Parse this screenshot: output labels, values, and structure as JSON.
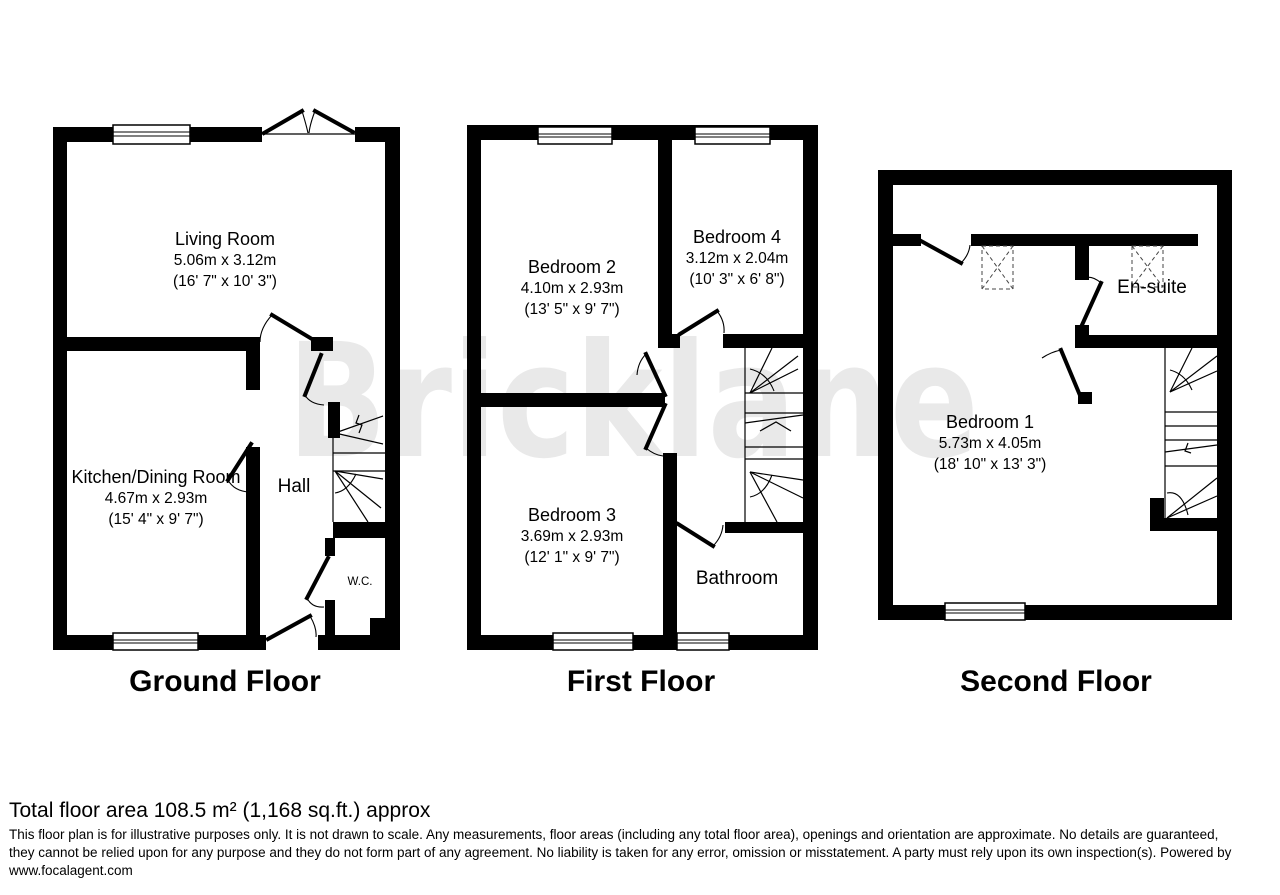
{
  "watermark": {
    "text": "Bricklane",
    "color": "#e9e9e9"
  },
  "floors": [
    {
      "caption": "Ground Floor",
      "rooms": [
        {
          "name": "Living Room",
          "dim_metric": "5.06m x 3.12m",
          "dim_imperial": "(16' 7\" x 10' 3\")"
        },
        {
          "name": "Kitchen/Dining Room",
          "dim_metric": "4.67m x 2.93m",
          "dim_imperial": "(15' 4\" x 9' 7\")"
        },
        {
          "name": "Hall"
        },
        {
          "name": "W.C."
        }
      ]
    },
    {
      "caption": "First Floor",
      "rooms": [
        {
          "name": "Bedroom 2",
          "dim_metric": "4.10m x 2.93m",
          "dim_imperial": "(13' 5\" x 9' 7\")"
        },
        {
          "name": "Bedroom 4",
          "dim_metric": "3.12m x 2.04m",
          "dim_imperial": "(10' 3\" x 6' 8\")"
        },
        {
          "name": "Bedroom 3",
          "dim_metric": "3.69m x 2.93m",
          "dim_imperial": "(12' 1\" x 9' 7\")"
        },
        {
          "name": "Bathroom"
        }
      ]
    },
    {
      "caption": "Second Floor",
      "rooms": [
        {
          "name": "Bedroom 1",
          "dim_metric": "5.73m x 4.05m",
          "dim_imperial": "(18' 10\" x 13' 3\")"
        },
        {
          "name": "En-suite"
        }
      ]
    }
  ],
  "footer": {
    "total_area": "Total floor area 108.5 m² (1,168 sq.ft.) approx",
    "disclaimer_lines": [
      "This floor plan is for illustrative purposes only. It is not drawn to scale. Any measurements, floor areas (including any total floor area), openings and orientation are approximate. No details are guaranteed,",
      "they cannot be relied upon for any purpose and they do not form part of any agreement. No liability is taken for any error, omission or misstatement. A party must rely upon its own inspection(s). Powered by",
      "www.focalagent.com"
    ]
  }
}
